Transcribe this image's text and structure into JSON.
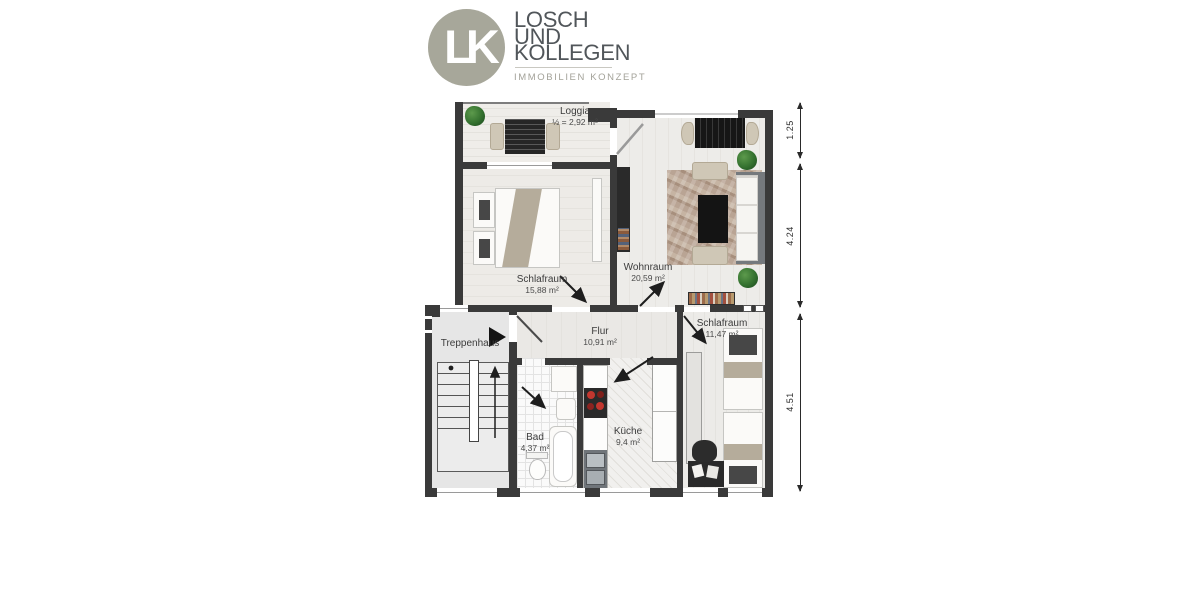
{
  "brand": {
    "monogram": "LK",
    "line1": "LOSCH",
    "line2": "UND",
    "line3": "KOLLEGEN",
    "tagline": "IMMOBILIEN KONZEPT",
    "circle_color": "#a7a79a",
    "name_color": "#51565a",
    "tagline_color": "#a3a299"
  },
  "floorplan": {
    "wall_color": "#3a3a3a",
    "rooms": {
      "loggia": {
        "name": "Loggia",
        "area": "½ = 2,92 m²"
      },
      "schlafraum_links": {
        "name": "Schlafraum",
        "area": "15,88 m²"
      },
      "wohnraum": {
        "name": "Wohnraum",
        "area": "20,59 m²"
      },
      "flur": {
        "name": "Flur",
        "area": "10,91 m²"
      },
      "schlafraum_rechts": {
        "name": "Schlafraum",
        "area": "11,47 m²"
      },
      "treppenhaus": {
        "name": "Treppenhaus",
        "area": ""
      },
      "bad": {
        "name": "Bad",
        "area": "4,37 m²"
      },
      "kueche": {
        "name": "Küche",
        "area": "9,4 m²"
      }
    },
    "dimensions": {
      "top": "1.25",
      "middle": "4.24",
      "bottom": "4.51"
    }
  }
}
